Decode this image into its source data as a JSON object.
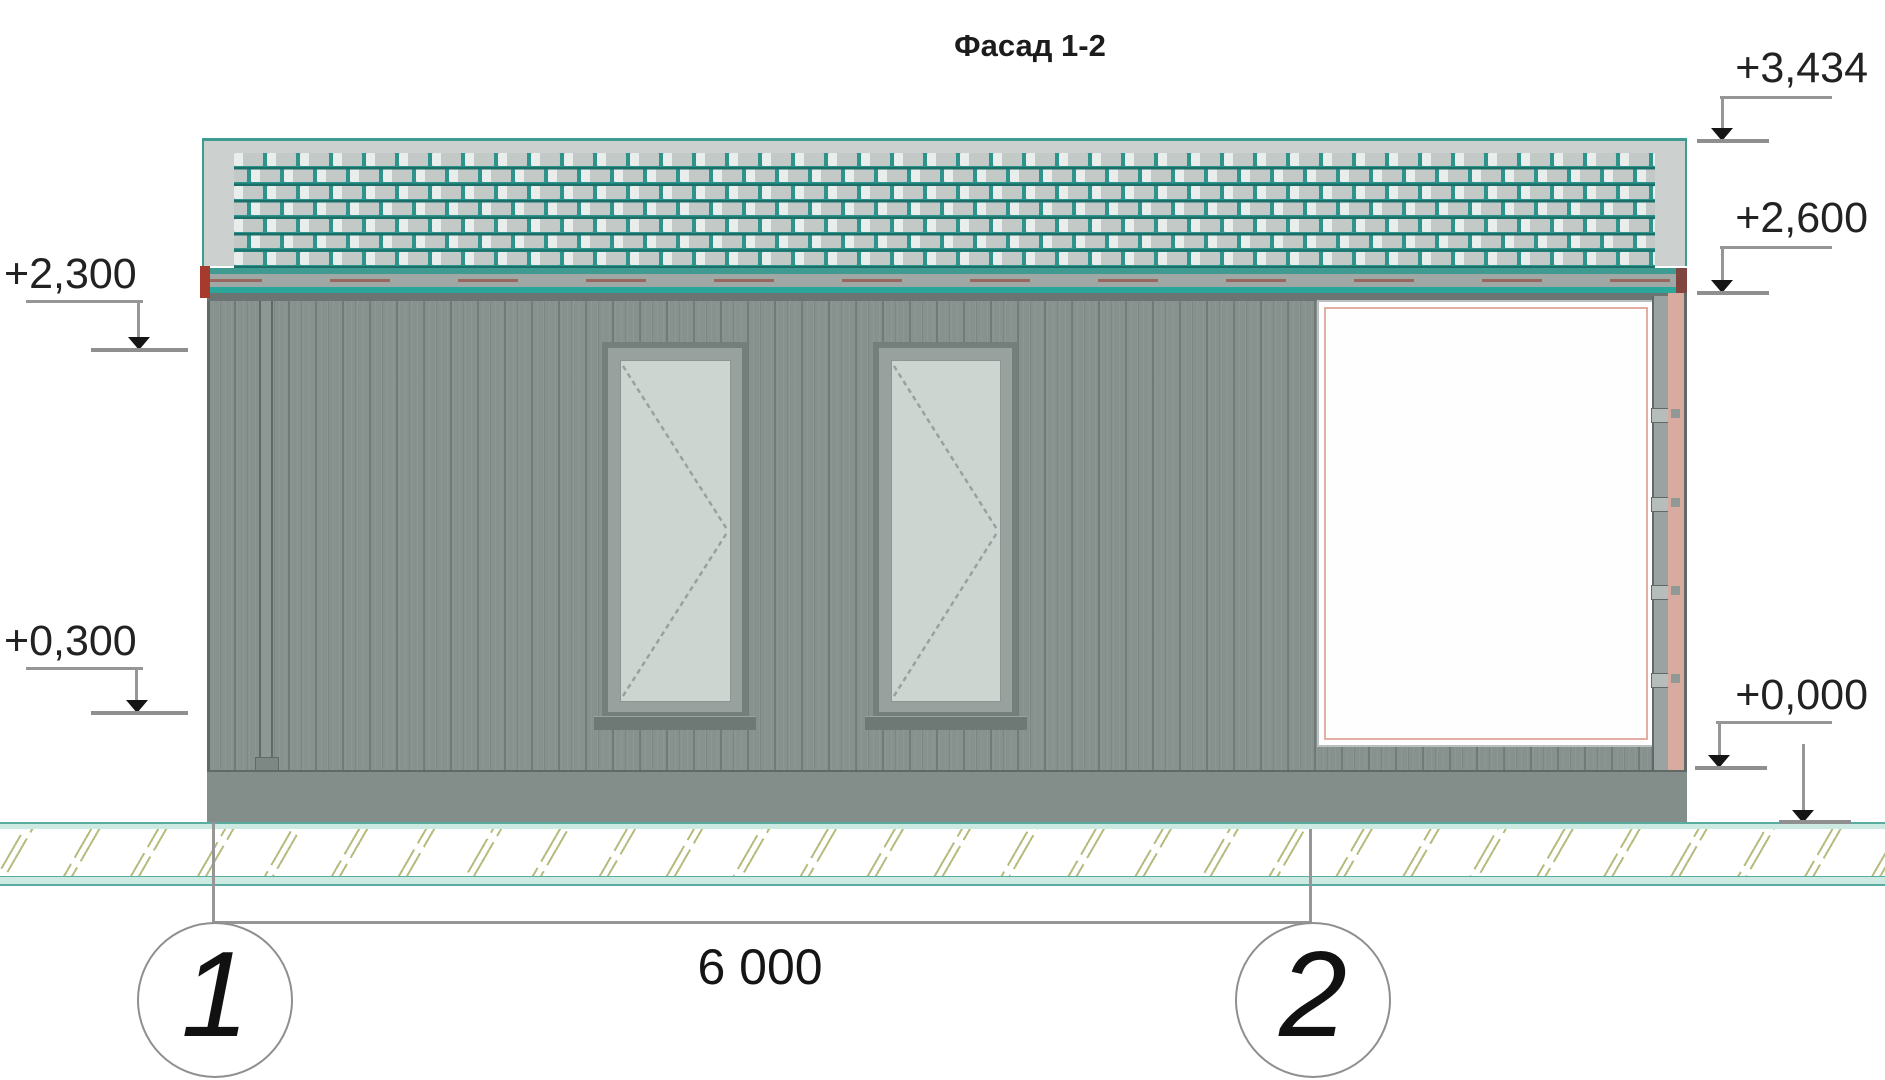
{
  "title": "Фасад 1-2",
  "dimension": {
    "value": "6 000"
  },
  "axes": [
    {
      "label": "1"
    },
    {
      "label": "2"
    }
  ],
  "elevations": {
    "left": [
      {
        "label": "+2,300"
      },
      {
        "label": "+0,300"
      }
    ],
    "right": [
      {
        "label": "+3,434"
      },
      {
        "label": "+2,600"
      },
      {
        "label": "+0,000"
      }
    ]
  },
  "colors": {
    "teal-grid": "#2d938b",
    "teal-dark": "#1a6f68",
    "tile": "#c2c9c7",
    "tile-hi": "#e9edeb",
    "roof-edge": "#3f9a92",
    "roof-band": "#ccd1cf",
    "eaves-teal": "#2aa69a",
    "eaves-gray": "#a0a8a6",
    "red": "#a63a2c",
    "red-dark": "#7e463f",
    "wall": "#87918e",
    "wall-dark": "#6b7472",
    "edge": "#5f6966",
    "frame": "#747e7b",
    "recess": "#98a19e",
    "glass": "#ccd5cf",
    "gate-white": "#fefefe",
    "pink": "#e2aea2",
    "pink-strip": "#d9aaa0",
    "strip-gray": "#9aa3a1",
    "plinth": "#838d8a",
    "ground-line": "#cdeae2",
    "ground-edge": "#58ada0",
    "hatch": "#b7bb7e",
    "line": "#969696",
    "ink": "#1d1d1d"
  }
}
